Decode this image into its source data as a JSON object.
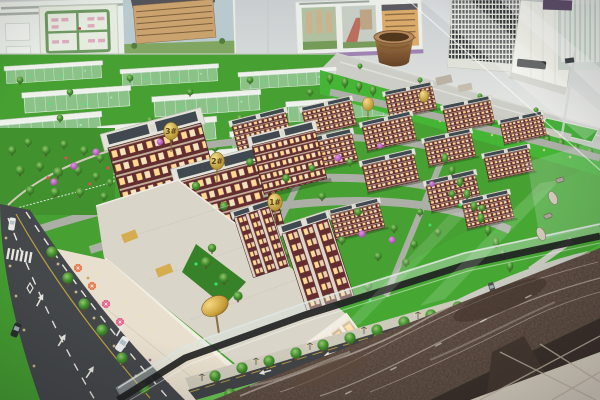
{
  "scene": {
    "subject": "Architectural scale model of a residential development displayed on a marble table in a sales center",
    "setting": "showroom with wall posters, floor-standing air conditioner, glass model enclosure"
  },
  "signs": {
    "s1": "1#",
    "s2": "2#",
    "s3": "3#"
  },
  "palette": {
    "grass": "#3f9e2c",
    "bright_lawn": "#46bb32",
    "building_brick": "#5e272b",
    "roof": "#e2e3da",
    "roof_panel": "#39434a",
    "road_dark": "#3e4246",
    "inner_road": "#a9ada5",
    "window_lit": "#ffd98f",
    "gold_sign": "#d4ab4a",
    "marble": "#4a382f",
    "showroom_floor": "#d9d2c2",
    "wall": "#dfe3e2",
    "poster_stripe": "#9b7fb2",
    "ac_white": "#f1f2ec",
    "glass_tint": "#d2e4e2",
    "flower_tree": "#b455c0"
  }
}
